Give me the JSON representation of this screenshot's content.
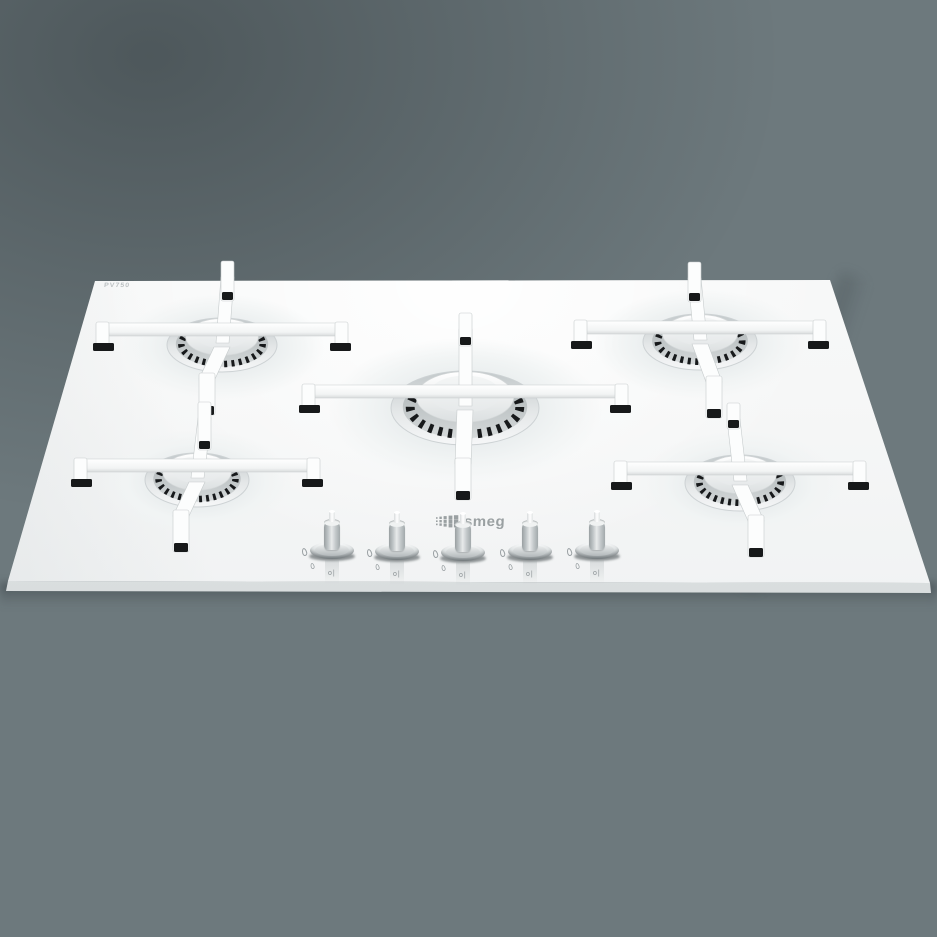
{
  "scene": {
    "background": {
      "wall_left": "#454e52",
      "wall_right": "#96a3a7",
      "counter_left": "#5f686c",
      "counter_right": "#8e999d",
      "counter_face": "#5d666a",
      "crease": "#3a4245"
    },
    "hob": {
      "glass_color": "#f6f7f7",
      "trivet_color": "#fcfdfd",
      "foot_color": "#17191a",
      "port_color": "#17191b",
      "ring_edge_color": "#cdd2d4",
      "corners": [
        [
          95,
          281
        ],
        [
          830,
          280
        ],
        [
          930,
          583
        ],
        [
          8,
          581
        ]
      ]
    },
    "branding": {
      "logo_text": "smeg",
      "logo_color": "#9aa0a2",
      "etched_marking": "PV750"
    },
    "knob_markings": {
      "off_ignition_text": "o|",
      "flame_large_icon": "flame-icon",
      "flame_small_icon": "flame-icon"
    },
    "burners": [
      {
        "name": "burner-back-left",
        "cx": 222,
        "cy": 345,
        "rx": 55,
        "ry": 27,
        "beam": 118,
        "beamY": -15,
        "backTop": -84,
        "backFoot": -52,
        "frontFoot": 64,
        "lean": -15,
        "backLean": 5
      },
      {
        "name": "burner-back-right",
        "cx": 700,
        "cy": 342,
        "rx": 57,
        "ry": 28,
        "beam": 118,
        "beamY": -14,
        "backTop": -80,
        "backFoot": -48,
        "frontFoot": 70,
        "lean": 14,
        "backLean": -6
      },
      {
        "name": "burner-center",
        "cx": 465,
        "cy": 408,
        "rx": 74,
        "ry": 37,
        "beam": 155,
        "beamY": -16,
        "backTop": -95,
        "backFoot": -70,
        "frontFoot": 86,
        "lean": -2,
        "backLean": 0
      },
      {
        "name": "burner-front-left",
        "cx": 197,
        "cy": 480,
        "rx": 52,
        "ry": 27,
        "beam": 115,
        "beamY": -14,
        "backTop": -78,
        "backFoot": -38,
        "frontFoot": 66,
        "lean": -16,
        "backLean": 7
      },
      {
        "name": "burner-front-right",
        "cx": 740,
        "cy": 483,
        "rx": 55,
        "ry": 28,
        "beam": 118,
        "beamY": -14,
        "backTop": -80,
        "backFoot": -62,
        "frontFoot": 68,
        "lean": 16,
        "backLean": -7
      }
    ],
    "knobs": [
      {
        "name": "burner-control-knob-1",
        "x": 332,
        "baseY": 552
      },
      {
        "name": "burner-control-knob-2",
        "x": 397,
        "baseY": 553
      },
      {
        "name": "burner-control-knob-3",
        "x": 463,
        "baseY": 554
      },
      {
        "name": "burner-control-knob-4",
        "x": 530,
        "baseY": 553
      },
      {
        "name": "burner-control-knob-5",
        "x": 597,
        "baseY": 552
      }
    ]
  }
}
